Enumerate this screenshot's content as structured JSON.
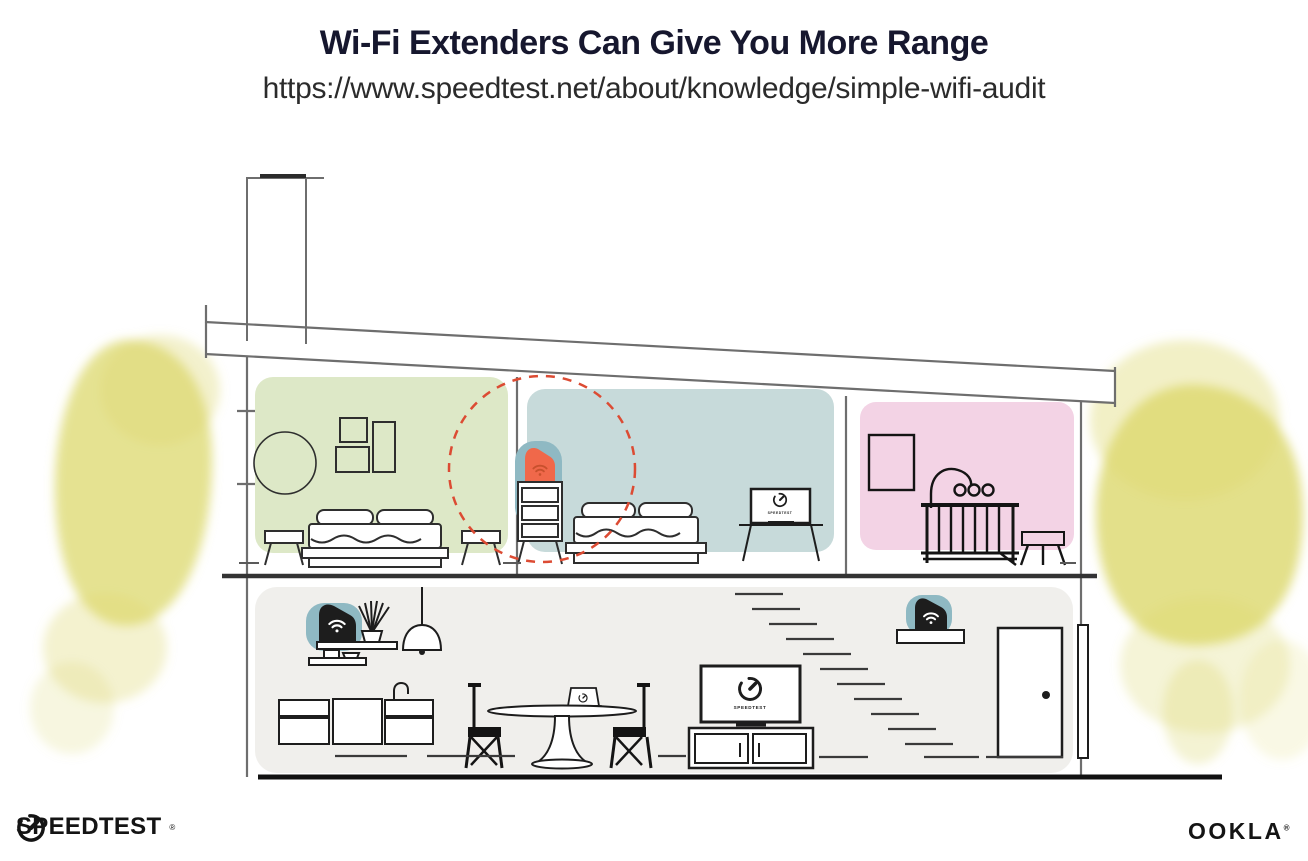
{
  "header": {
    "title": "Wi-Fi Extenders Can Give You More Range",
    "url": "https://www.speedtest.net/about/knowledge/simple-wifi-audit"
  },
  "house": {
    "tv_bedroom_screen_label": "SPEEDTEST",
    "tv_living_screen_label": "SPEEDTEST",
    "colors": {
      "room_green": "#dde8c7",
      "room_blue": "#c7dada",
      "room_pink": "#f3d3e5",
      "floor_gray": "#f0efec",
      "tree_yellow": "#dcd86d",
      "device_teal": "#8fb9c3",
      "extender_orange": "#f0684a",
      "extender_wifi_orange": "#c8502d",
      "coverage_red": "#dc4b33",
      "structure_line": "#6e6e6e",
      "furniture_line": "#2e2e2e",
      "dark": "#141414"
    }
  },
  "footer": {
    "speedtest_wordmark": "SPEEDTEST",
    "ookla_wordmark": "OOKLA",
    "registered_mark": "®"
  }
}
